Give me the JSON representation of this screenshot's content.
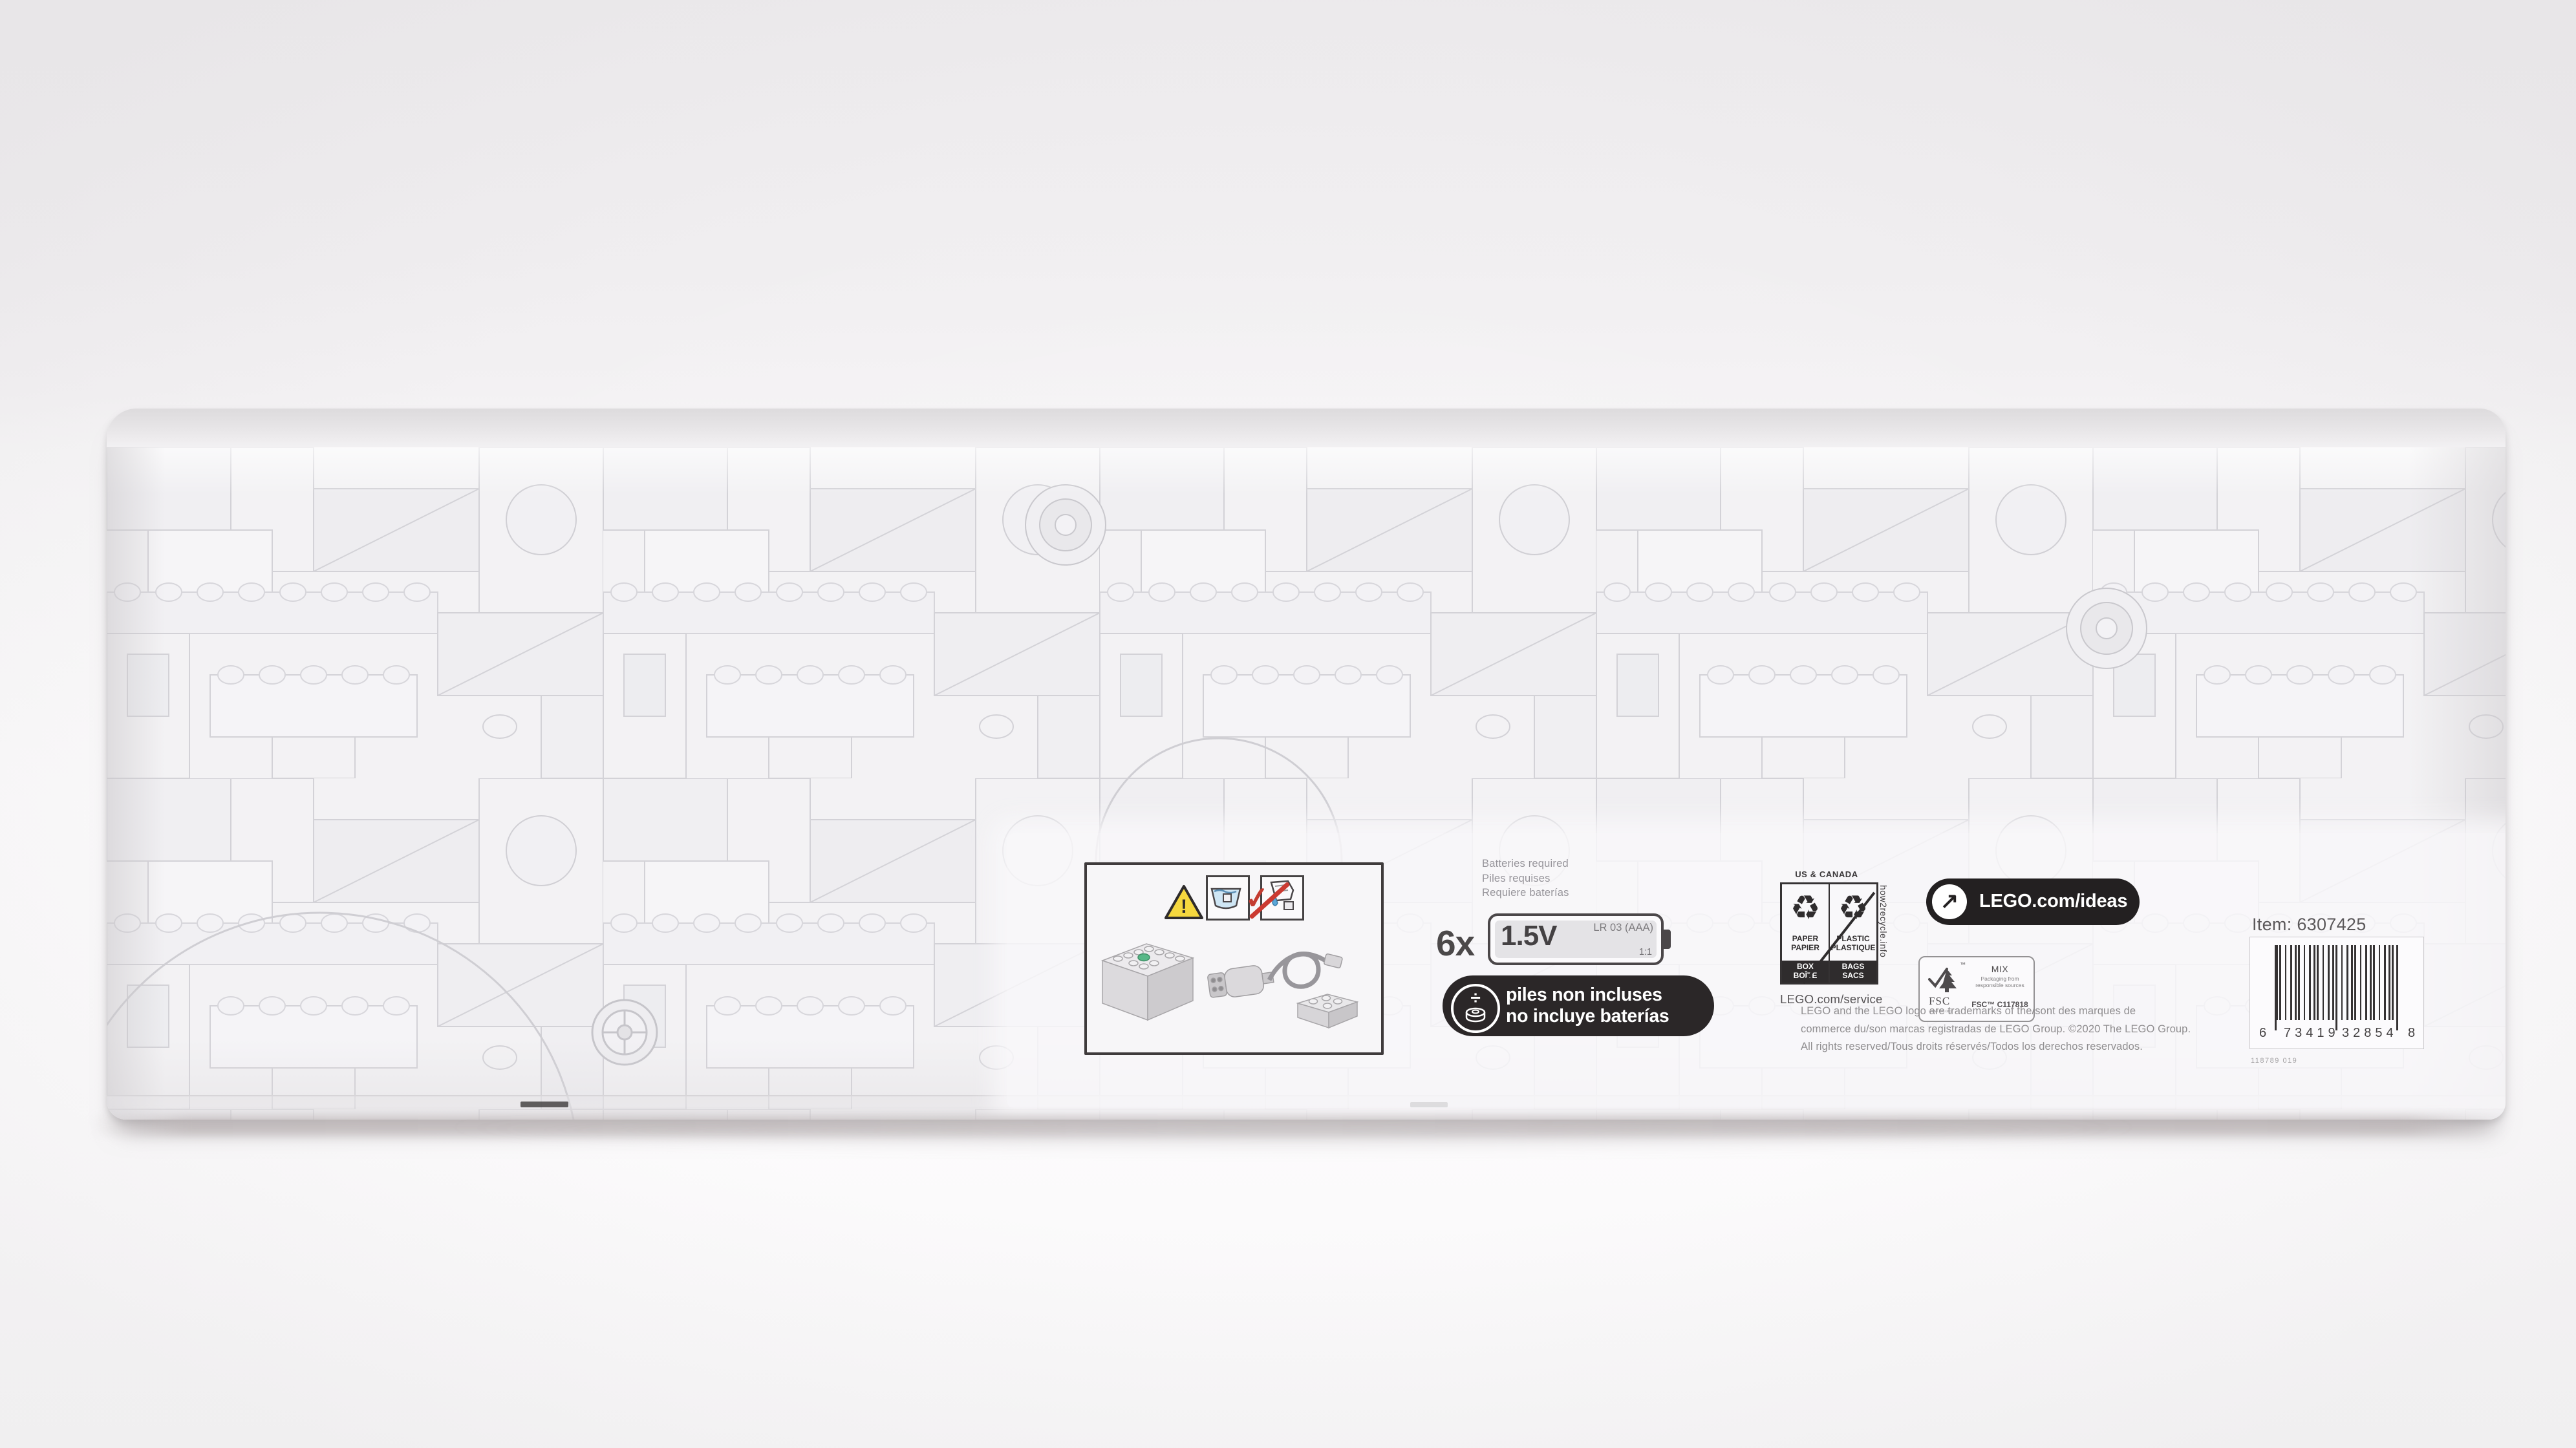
{
  "panel": {
    "warning": {
      "exclamation": "!",
      "check_glyph": "✓"
    },
    "batteries_required": [
      "Batteries required",
      "Piles requises",
      "Requiere baterías"
    ],
    "battery": {
      "qty": "6x",
      "voltage": "1.5V",
      "type": "LR 03 (AAA)",
      "ratio": "1:1"
    },
    "not_included": {
      "glyph": "÷",
      "lines": [
        "piles non incluses",
        "no incluye baterías"
      ]
    },
    "recycle": {
      "header": "US & CANADA",
      "glyph": "♻",
      "paper": {
        "material": [
          "PAPER",
          "PAPIER"
        ],
        "item": [
          "BOX",
          "BOÎTE"
        ]
      },
      "plastic": {
        "material": [
          "PLASTIC",
          "PLASTIQUE"
        ],
        "item": [
          "BAGS",
          "SACS"
        ]
      },
      "side_text": "how2recycle.info"
    },
    "service_url": "LEGO.com/service",
    "ideas": {
      "arrow": "↗",
      "url": "LEGO.com/ideas"
    },
    "fsc": {
      "name": "FSC",
      "tm": "™",
      "url": "www.fsc.org",
      "grade": "MIX",
      "tagline": [
        "Packaging from",
        "responsible sources"
      ],
      "license": "FSC™ C117818"
    },
    "legal": [
      "LEGO and the LEGO logo are trademarks of the/sont des marques de",
      "commerce du/son marcas registradas de LEGO Group. ©2020 The LEGO Group.",
      "All rights reserved/Tous droits réservés/Todos los derechos reservados."
    ],
    "item_label": "Item: 6307425",
    "barcode": {
      "lead": "6",
      "group1": "73419",
      "group2": "32854",
      "trail": "8"
    },
    "print_code": "118789  019"
  },
  "colors": {
    "pill_bg": "#2b2728",
    "warning_yellow": "#f5d73e",
    "alert_red": "#c43c31",
    "box_white": "#f3f2f4",
    "panel_white": "#f9f8fa"
  }
}
